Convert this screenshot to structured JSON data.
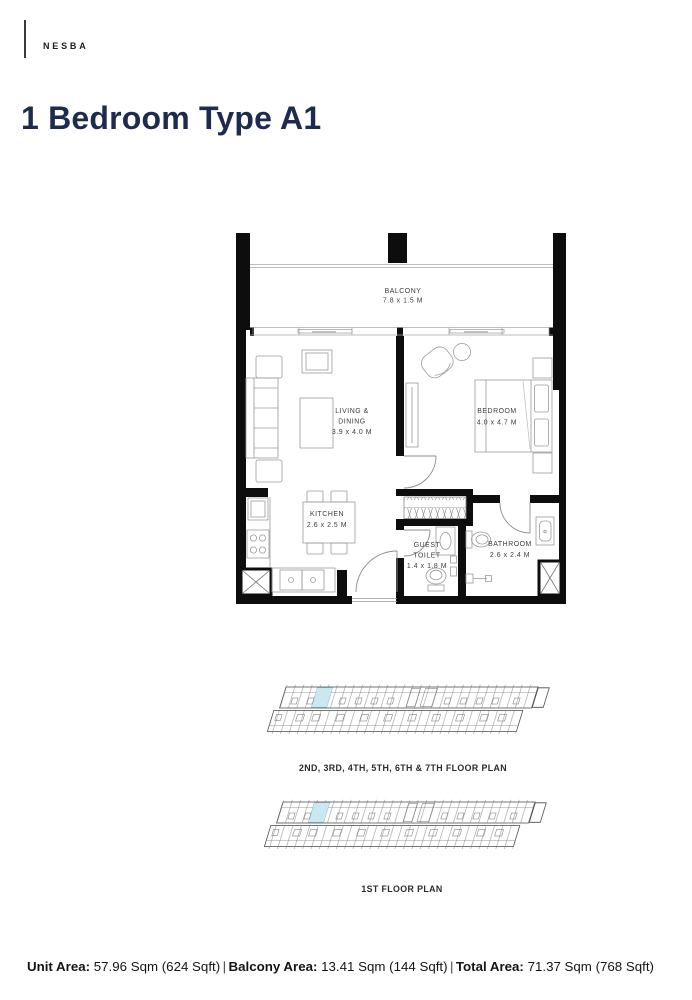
{
  "brand": "NESBA",
  "page_title": "1 Bedroom Type A1",
  "plan": {
    "balcony": {
      "name": "BALCONY",
      "dims": "7.8 x 1.5 M"
    },
    "living": {
      "line1": "LIVING &",
      "line2": "DINING",
      "dims": "3.9 x 4.0 M"
    },
    "bedroom": {
      "name": "BEDROOM",
      "dims": "4.0 x 4.7 M"
    },
    "kitchen": {
      "name": "KITCHEN",
      "dims": "2.6 x 2.5 M"
    },
    "guest_toilet": {
      "line1": "GUEST",
      "line2": "TOILET",
      "dims": "1.4 x 1.8 M"
    },
    "bathroom": {
      "name": "BATHROOM",
      "dims": "2.6 x 2.4 M"
    }
  },
  "key_plans": [
    {
      "label": "2ND, 3RD, 4TH, 5TH, 6TH & 7TH FLOOR PLAN"
    },
    {
      "label": "1ST FLOOR PLAN"
    }
  ],
  "footer": {
    "separator": "|",
    "items": [
      {
        "label": "Unit Area:",
        "value": "57.96 Sqm (624 Sqft)"
      },
      {
        "label": "Balcony Area:",
        "value": "13.41 Sqm (144 Sqft)"
      },
      {
        "label": "Total Area:",
        "value": "71.37 Sqm (768 Sqft)"
      }
    ]
  },
  "colors": {
    "title_navy": "#1d2c4e",
    "wall_black": "#0d0d0d",
    "unit_highlight": "#cbe7f2"
  }
}
